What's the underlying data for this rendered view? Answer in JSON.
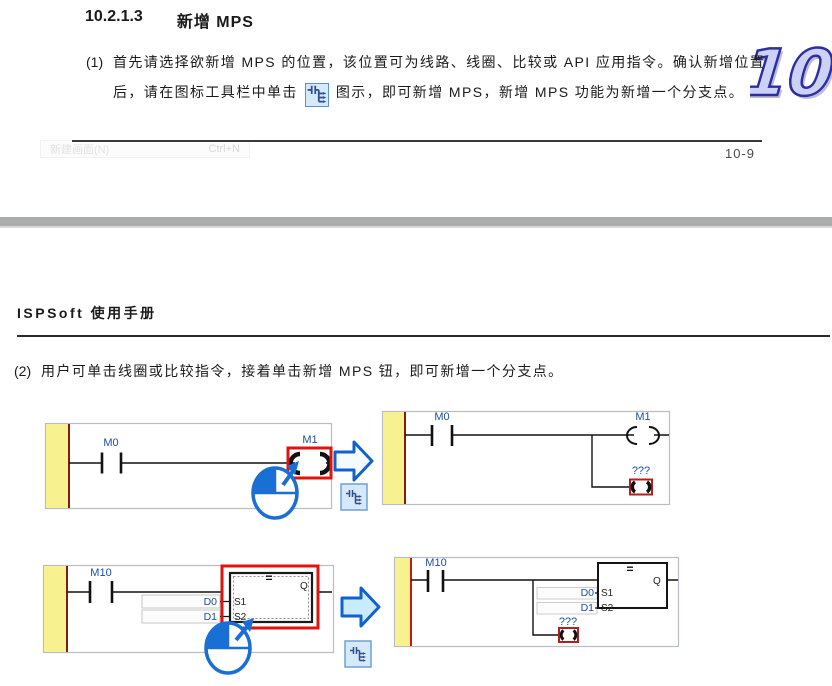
{
  "colors": {
    "accent_blue": "#1565d8",
    "label_blue": "#1f4fa0",
    "highlight_red": "#e0140f",
    "rail_yellow": "#f8f18f",
    "rail_edge_red": "#7a2013",
    "icon_button_bg": "#d6e9fa",
    "divider_gray": "#a9abad"
  },
  "icons": {
    "mps_button": "mps-branch-icon",
    "mouse": "mouse-click-icon",
    "arrow": "block-arrow-right-icon"
  },
  "doc": {
    "section_number": "10.2.1.3",
    "section_title": "新增 MPS",
    "chapter_badge": "10",
    "page_number": "10-9",
    "manual_header": "ISPSoft 使用手册",
    "ghost_menu": {
      "label": "新建画面(N)",
      "shortcut": "Ctrl+N"
    },
    "step1": {
      "marker": "(1)",
      "line1": "首先请选择欲新增 MPS 的位置，该位置可为线路、线圈、比较或 API 应用指令。确认新增位置",
      "line2_before_icon": "后，请在图标工具栏中单击",
      "line2_after_icon": "图示，即可新增 MPS，新增 MPS 功能为新增一个分支点。"
    },
    "step2": {
      "marker": "(2)",
      "text": "用户可单击线圈或比较指令，接着单击新增 MPS 钮，即可新增一个分支点。"
    }
  },
  "ladder": {
    "before_coil": {
      "contact": "M0",
      "coil": "M1"
    },
    "after_coil": {
      "contact": "M0",
      "coil": "M1",
      "new_branch": "???"
    },
    "before_block": {
      "contact": "M10",
      "operator": "=",
      "pin_s1": "S1",
      "pin_s2": "S2",
      "operand1": "D0",
      "operand2": "D1",
      "output": "Q"
    },
    "after_block": {
      "contact": "M10",
      "operator": "=",
      "pin_s1": "S1",
      "pin_s2": "S2",
      "operand1": "D0",
      "operand2": "D1",
      "output": "Q",
      "new_branch": "???"
    }
  }
}
